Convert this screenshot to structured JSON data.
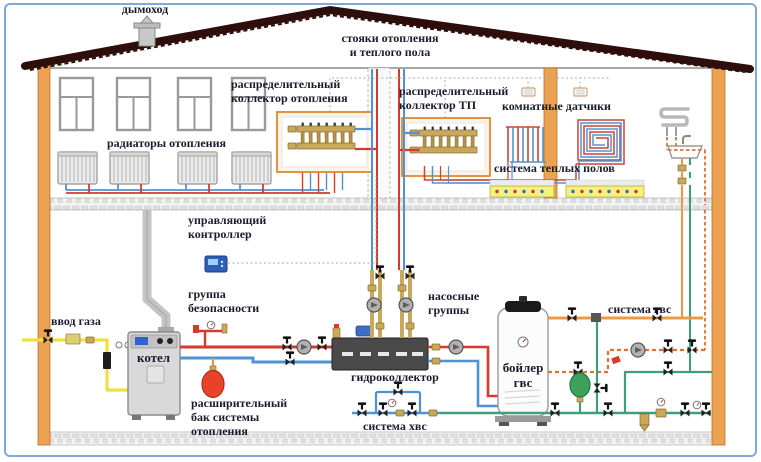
{
  "diagram": {
    "title": "Схема отопления и водоснабжения дома",
    "labels": {
      "chimney": "дымоход",
      "risers": "стояки отопления\nи теплого пола",
      "heating_collector": "распределительный\nколлектор отопления",
      "tp_collector": "распределительный\nколлектор ТП",
      "room_sensors": "комнатные датчики",
      "radiators": "радиаторы отопления",
      "floor_heating": "система теплых полов",
      "controller": "управляющий\nконтроллер",
      "gas_inlet": "ввод газа",
      "boiler": "котел",
      "safety_group": "группа\nбезопасности",
      "expansion_tank": "расширительный\nбак системы\nотопления",
      "hydrocollector": "гидроколлектор",
      "pump_groups": "насосные\nгруппы",
      "dhw_boiler": "бойлер\nгвс",
      "dhw_system": "система гвс",
      "cold_water_system": "система хвс"
    },
    "colors": {
      "frame": "#7fa9d6",
      "wall": "#eda153",
      "roof": "#2d0e0b",
      "supply_pipe": "#d63a2a",
      "return_pipe": "#4f93d6",
      "gas_pipe": "#f0e03c",
      "dhw_pipe": "#ee9843",
      "recirculation_pipe": "#e07038",
      "cold_water_pipe": "#3f9e7a",
      "brass": "#c9a85c",
      "hydrocollector_body": "#4a4a4a",
      "expansion_tank_red": "#e8432a",
      "expansion_vessel_green": "#3da05c"
    }
  }
}
